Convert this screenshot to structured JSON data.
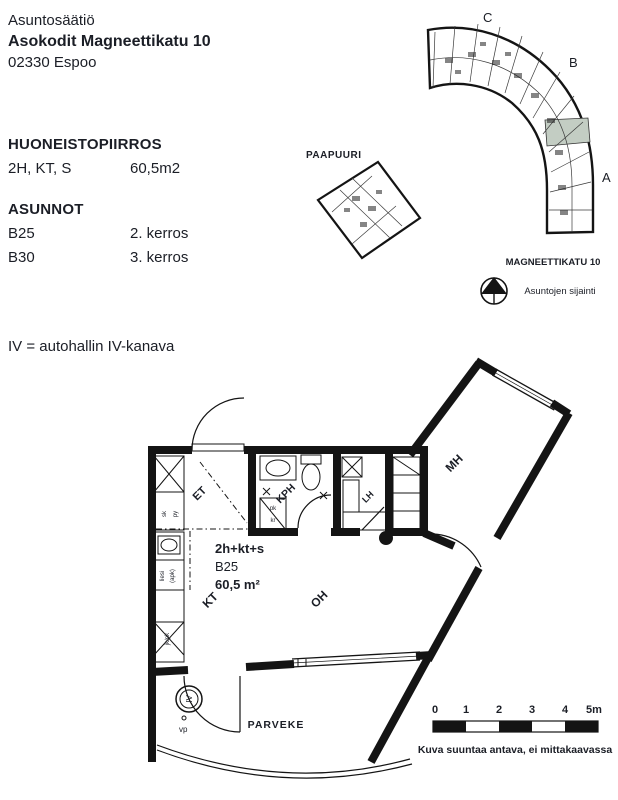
{
  "colors": {
    "ink": "#1b1e26",
    "wall": "#141414",
    "highlight": "#c3cdc3"
  },
  "header": {
    "org": "Asuntosäätiö",
    "building": "Asokodit Magneettikatu 10",
    "city": "02330 Espoo"
  },
  "info": {
    "drawing_title": "HUONEISTOPIIRROS",
    "layout": "2H, KT, S",
    "area": "60,5m2",
    "apartments_title": "ASUNNOT",
    "apartments": [
      {
        "id": "B25",
        "floor": "2. kerros"
      },
      {
        "id": "B30",
        "floor": "3. kerros"
      }
    ],
    "note": "IV = autohallin IV-kanava"
  },
  "siteplan": {
    "neighbor_building": "PAAPUURI",
    "section_c": "C",
    "section_b": "B",
    "section_a": "A",
    "street": "MAGNEETTIKATU 10",
    "legend": "Asuntojen sijainti"
  },
  "floorplan": {
    "unit_type": "2h+kt+s",
    "unit_id": "B25",
    "unit_area": "60,5 m²",
    "rooms": {
      "et": "ET",
      "kph": "KPH",
      "lh": "LH",
      "mh": "MH",
      "kt": "KT",
      "oh": "OH",
      "parveke": "PARVEKE"
    },
    "fixtures": {
      "iv": "IV",
      "vp": "vp",
      "sk": "sk",
      "py": "py",
      "pk": "pk",
      "kr": "kr",
      "liesi": "liesi",
      "apk": "(apk)",
      "jk_pk": "jk/pk"
    }
  },
  "scalebar": {
    "ticks": [
      "0",
      "1",
      "2",
      "3",
      "4",
      "5m"
    ],
    "caption": "Kuva suuntaa antava, ei mittakaavassa"
  }
}
